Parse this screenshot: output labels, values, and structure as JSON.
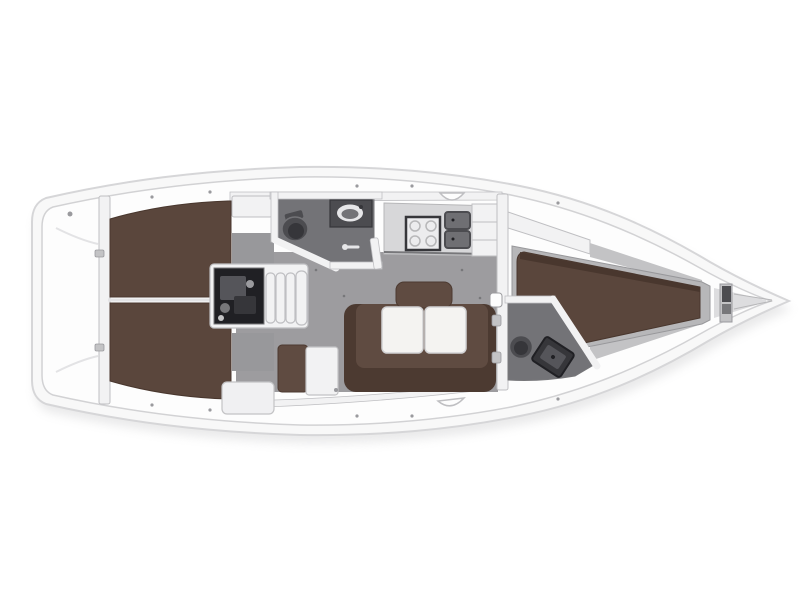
{
  "colors": {
    "background": "#ffffff",
    "hull": "#f8f8f8",
    "hull_stroke": "#d6d6d8",
    "hull_shadow": "#c9c9cb",
    "deck": "#fdfdfd",
    "deck_stroke": "#d2d2d4",
    "wall": "#f2f2f3",
    "wall_stroke": "#bfbfc2",
    "locker_gray": "#c3c3c5",
    "frame_gray": "#b7b7b9",
    "floor": "#9d9c9f",
    "corridor": "#98989b",
    "berth": "#5a463c",
    "berth_dark": "#49372e",
    "sofa": "#5f4b41",
    "sofa_dark": "#4c3a31",
    "bath_floor": "#737377",
    "fixture": "#4c4c50",
    "fixture_dark": "#36363a",
    "engine": "#202024",
    "engine_part": "#55555a",
    "counter": "#d7d7d9",
    "counter_edge": "#77777a",
    "stove_face": "#ececee",
    "sink": "#6f6f73",
    "table": "#f4f3f1",
    "table_stroke": "#d2d2d4",
    "white_furniture": "#f0f0f2",
    "metal": "#9a9a9e",
    "basin": "#e6e6e8",
    "seam": "#e3e3e5"
  },
  "features": {
    "vessel": "sailing-yacht-interior-floorplan",
    "stern": [
      "swim-platform",
      "transom-bulkhead"
    ],
    "aft_cabins": [
      "port-double-berth",
      "starboard-double-berth",
      "engine-compartment",
      "companionway-steps"
    ],
    "midship": [
      "aft-head-toilet",
      "aft-head-washbasin",
      "aft-head-shower",
      "galley-stove",
      "galley-double-sink",
      "salon-sofa",
      "salon-folding-table",
      "chart-table-seat",
      "chart-table"
    ],
    "forward": [
      "forward-head-toilet",
      "forward-head-vanity",
      "v-berth",
      "anchor-windlass"
    ]
  }
}
